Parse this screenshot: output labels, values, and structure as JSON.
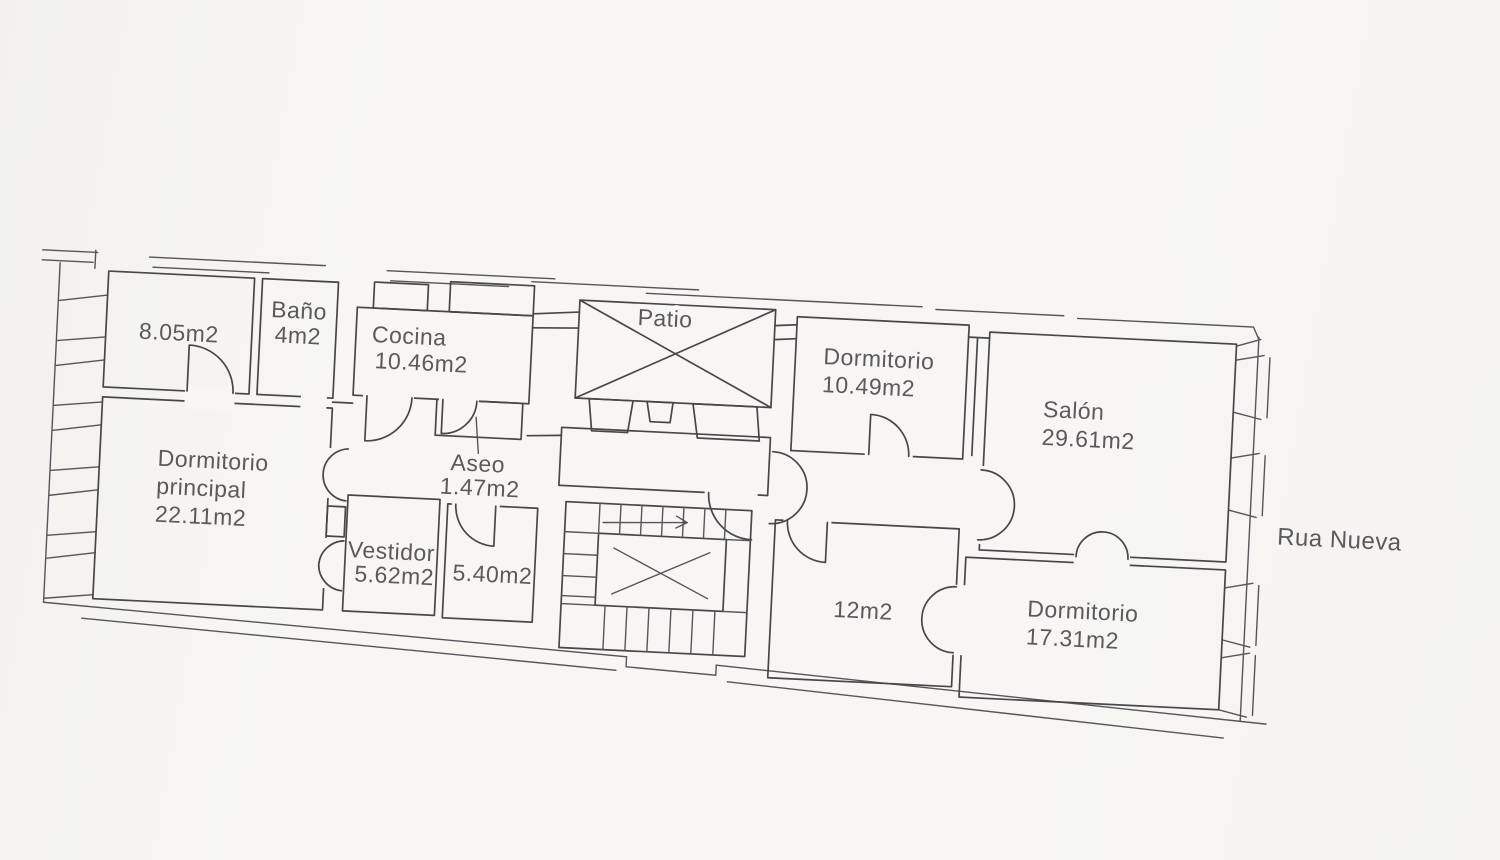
{
  "plan": {
    "street": {
      "label": "Rua Nueva"
    },
    "rooms": {
      "r805": {
        "area": "8.05m2"
      },
      "bano": {
        "name": "Baño",
        "area": "4m2"
      },
      "cocina": {
        "name": "Cocina",
        "area": "10.46m2"
      },
      "patio": {
        "name": "Patio"
      },
      "aseo": {
        "name": "Aseo",
        "area": "1.47m2"
      },
      "dormitorio_principal": {
        "name": "Dormitorio",
        "name2": "principal",
        "area": "22.11m2"
      },
      "vestidor": {
        "name": "Vestidor",
        "area": "5.62m2"
      },
      "r540": {
        "area": "5.40m2"
      },
      "dormitorio2": {
        "name": "Dormitorio",
        "area": "10.49m2"
      },
      "r12": {
        "area": "12m2"
      },
      "salon": {
        "name": "Salón",
        "area": "29.61m2"
      },
      "dormitorio3": {
        "name": "Dormitorio",
        "area": "17.31m2"
      }
    },
    "colors": {
      "ink": "#47474a",
      "label": "#5a5a5c",
      "paper": "#f7f6f4"
    }
  }
}
